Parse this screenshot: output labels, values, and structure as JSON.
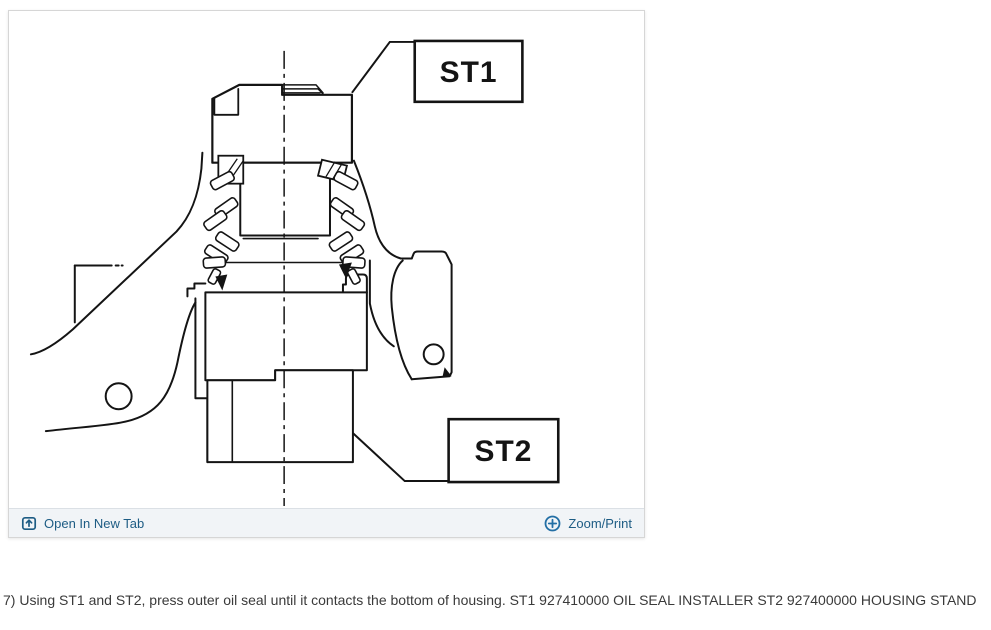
{
  "viewer": {
    "toolbar": {
      "open_in_new_tab": {
        "label": "Open In New Tab",
        "icon": "open-in-new-tab-icon"
      },
      "zoom_print": {
        "label": "Zoom/Print",
        "icon": "zoom-plus-icon"
      }
    },
    "diagram": {
      "type": "technical-line-drawing",
      "subject": "Pressing outer oil seal into housing with special tools",
      "labels": [
        {
          "id": "st1",
          "text": "ST1"
        },
        {
          "id": "st2",
          "text": "ST2"
        }
      ]
    }
  },
  "caption": "7) Using ST1 and ST2, press outer oil seal until it contacts the bottom of housing. ST1 927410000 OIL SEAL INSTALLER ST2 927400000 HOUSING STAND",
  "colors": {
    "link": "#1d5c84",
    "icon_accent": "#236fa5",
    "toolbar_bg": "#f1f4f7",
    "line": "#141414"
  }
}
